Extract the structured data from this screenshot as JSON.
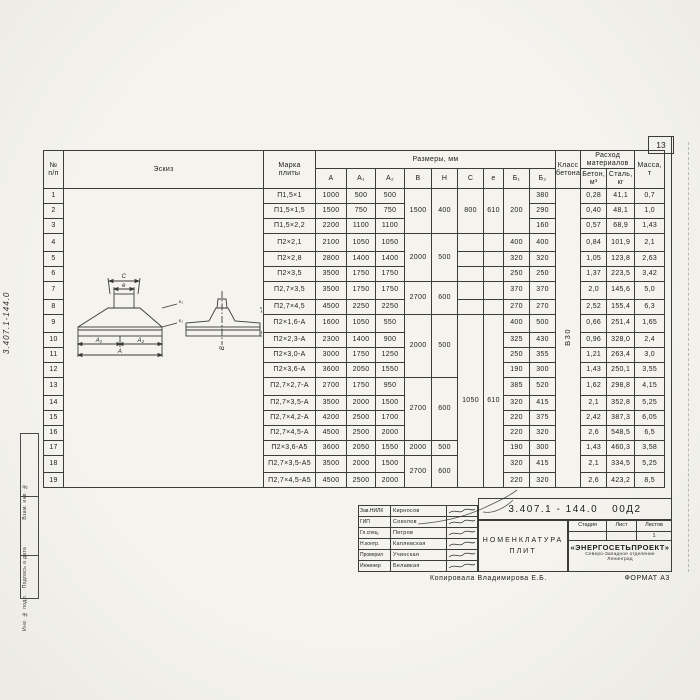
{
  "page": {
    "number": "13"
  },
  "margin": {
    "code": "3.407.1-144.0",
    "stamps": [
      "Взам. инв. №",
      "Подпись и дата",
      "Инв. № подл."
    ]
  },
  "table": {
    "headers": {
      "num": "№\nп/п",
      "sketch": "Эскиз",
      "marka": "Марка\nплиты",
      "razmery": "Размеры,  мм",
      "dims": [
        "A",
        "A₁",
        "A₂",
        "B",
        "H",
        "C",
        "e",
        "Б₁",
        "Б₂"
      ],
      "klass": "Класс\nбетона",
      "rashod": "Расход\nматериалов",
      "beton": "Бетон,\nм³",
      "stal": "Сталь,\nкг",
      "massa": "Масса,\nт"
    },
    "rows": [
      [
        "1",
        "П1,5×1",
        "1000",
        "500",
        "500",
        "",
        "380",
        "0,28",
        "41,1",
        "0,7"
      ],
      [
        "2",
        "П1,5×1,5",
        "1500",
        "750",
        "750",
        "",
        "290",
        "0,40",
        "48,1",
        "1,0"
      ],
      [
        "3",
        "П1,5×2,2",
        "2200",
        "1100",
        "1100",
        "",
        "160",
        "0,57",
        "68,9",
        "1,43"
      ],
      [
        "4",
        "П2×2,1",
        "2100",
        "1050",
        "1050",
        "400",
        "400",
        "0,84",
        "101,9",
        "2,1"
      ],
      [
        "5",
        "П2×2,8",
        "2800",
        "1400",
        "1400",
        "320",
        "320",
        "1,05",
        "123,8",
        "2,63"
      ],
      [
        "6",
        "П2×3,5",
        "3500",
        "1750",
        "1750",
        "250",
        "250",
        "1,37",
        "223,5",
        "3,42"
      ],
      [
        "7",
        "П2,7×3,5",
        "3500",
        "1750",
        "1750",
        "370",
        "370",
        "2,0",
        "145,6",
        "5,0"
      ],
      [
        "8",
        "П2,7×4,5",
        "4500",
        "2250",
        "2250",
        "270",
        "270",
        "2,52",
        "155,4",
        "6,3"
      ],
      [
        "9",
        "П2×1,6-А",
        "1600",
        "1050",
        "550",
        "400",
        "500",
        "0,66",
        "251,4",
        "1,65"
      ],
      [
        "10",
        "П2×2,3-А",
        "2300",
        "1400",
        "900",
        "325",
        "430",
        "0,96",
        "328,0",
        "2,4"
      ],
      [
        "11",
        "П2×3,0-А",
        "3000",
        "1750",
        "1250",
        "250",
        "355",
        "1,21",
        "263,4",
        "3,0"
      ],
      [
        "12",
        "П2×3,6-А",
        "3600",
        "2050",
        "1550",
        "190",
        "300",
        "1,43",
        "250,1",
        "3,55"
      ],
      [
        "13",
        "П2,7×2,7-А",
        "2700",
        "1750",
        "950",
        "385",
        "520",
        "1,62",
        "298,8",
        "4,15"
      ],
      [
        "14",
        "П2,7×3,5-А",
        "3500",
        "2000",
        "1500",
        "320",
        "415",
        "2,1",
        "352,8",
        "5,25"
      ],
      [
        "15",
        "П2,7×4,2-А",
        "4200",
        "2500",
        "1700",
        "220",
        "375",
        "2,42",
        "387,3",
        "6,05"
      ],
      [
        "16",
        "П2,7×4,5-А",
        "4500",
        "2500",
        "2000",
        "220",
        "320",
        "2,6",
        "548,5",
        "6,5"
      ],
      [
        "17",
        "П2×3,6-А5",
        "3600",
        "2050",
        "1550",
        "190",
        "300",
        "1,43",
        "460,3",
        "3,58"
      ],
      [
        "18",
        "П2,7×3,5-А5",
        "3500",
        "2000",
        "1500",
        "320",
        "415",
        "2,1",
        "334,5",
        "5,25"
      ],
      [
        "19",
        "П2,7×4,5-А5",
        "4500",
        "2500",
        "2000",
        "220",
        "320",
        "2,6",
        "423,2",
        "8,5"
      ]
    ],
    "merges": {
      "sketch": [
        [
          0,
          19,
          ""
        ]
      ],
      "B": [
        [
          0,
          3,
          "1500"
        ],
        [
          3,
          3,
          "2000"
        ],
        [
          6,
          2,
          "2700"
        ],
        [
          8,
          4,
          "2000"
        ],
        [
          12,
          4,
          "2700"
        ],
        [
          16,
          1,
          "2000"
        ],
        [
          17,
          2,
          "2700"
        ]
      ],
      "H": [
        [
          0,
          3,
          "400"
        ],
        [
          3,
          3,
          "500"
        ],
        [
          6,
          2,
          "600"
        ],
        [
          8,
          4,
          "500"
        ],
        [
          12,
          4,
          "600"
        ],
        [
          16,
          1,
          "500"
        ],
        [
          17,
          2,
          "600"
        ]
      ],
      "C": [
        [
          0,
          3,
          "800"
        ],
        [
          8,
          11,
          "1050"
        ]
      ],
      "e": [
        [
          0,
          3,
          "610"
        ],
        [
          8,
          11,
          "610"
        ]
      ],
      "b1": [
        [
          0,
          3,
          "200"
        ]
      ],
      "klass": [
        [
          0,
          19,
          "В30"
        ]
      ]
    }
  },
  "sketch": {
    "c": "C",
    "e": "e",
    "a1": "A₁",
    "a2": "A₂",
    "a": "A",
    "b": "В",
    "dim100": "100",
    "t1": "Б₁",
    "t2": "Б₂"
  },
  "titleblock": {
    "code_main": "3.407.1 - 144.0",
    "code_suffix": "00Д2",
    "doc_title_1": "Номенклатура",
    "doc_title_2": "плит",
    "sig_rows": [
      {
        "role": "Зав.НИЛК",
        "name": "Кирносов"
      },
      {
        "role": "ГИП",
        "name": "Соколов"
      },
      {
        "role": "Гл.спец.",
        "name": "Петров"
      },
      {
        "role": "Н.контр.",
        "name": "Каплевская"
      },
      {
        "role": "Проверил",
        "name": "Учинская"
      },
      {
        "role": "Инженер",
        "name": "Белавкая"
      }
    ],
    "stage_label": "Стадия",
    "sheet_label": "Лист",
    "sheets_label": "Листов",
    "stage_value": "",
    "sheet_value": "",
    "sheets_value": "1",
    "org": "«ЭНЕРГОСЕТЬПРОЕКТ»",
    "org_sub": "Северо-Западное отделение",
    "org_city": "Ленинград"
  },
  "footer": {
    "copied": "Копировала  Владимирова Е.Б.",
    "format": "ФОРМАТ А3"
  }
}
